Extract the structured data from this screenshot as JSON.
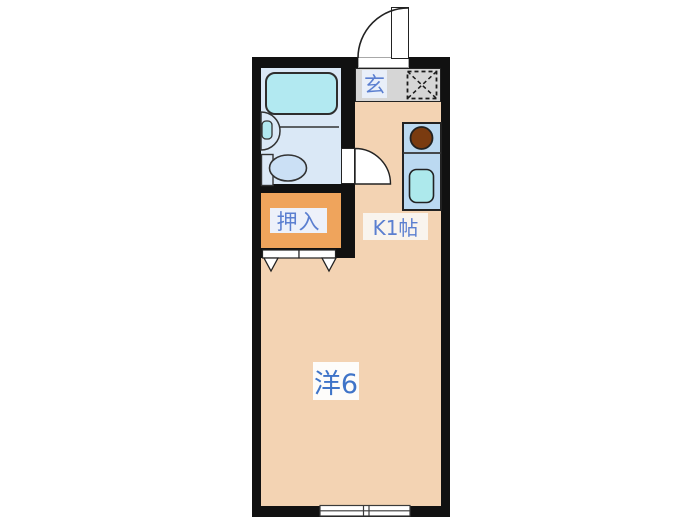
{
  "floorplan": {
    "labels": {
      "entrance": "玄",
      "kitchen": "K1帖",
      "closet": "押入",
      "main_room": "洋6"
    },
    "colors": {
      "wall": "#111111",
      "outline": "#222222",
      "floor_room": "#F3D3B3",
      "floor_closet": "#EFA45C",
      "floor_bath": "#DAE8F6",
      "floor_entrance": "#D6D6D6",
      "bathtub": "#B2E9F1",
      "kitchen_unit": "#BBD9F1",
      "kitchen_sink": "#ADE9EC",
      "stove_burner": "#7A3B10",
      "toilet": "#CBE0F5",
      "fixture": "#DCE9F7",
      "door_fill": "#FFFFFF",
      "text_blue": "#5B7FD0",
      "text_blue_strong": "#3F74C8",
      "label_bg_entrance": "#E9EFF9",
      "label_bg_kitchen": "#F9F4EE",
      "label_bg_closet": "#EDF1FA",
      "label_bg_room": "#FDFCFA"
    }
  }
}
